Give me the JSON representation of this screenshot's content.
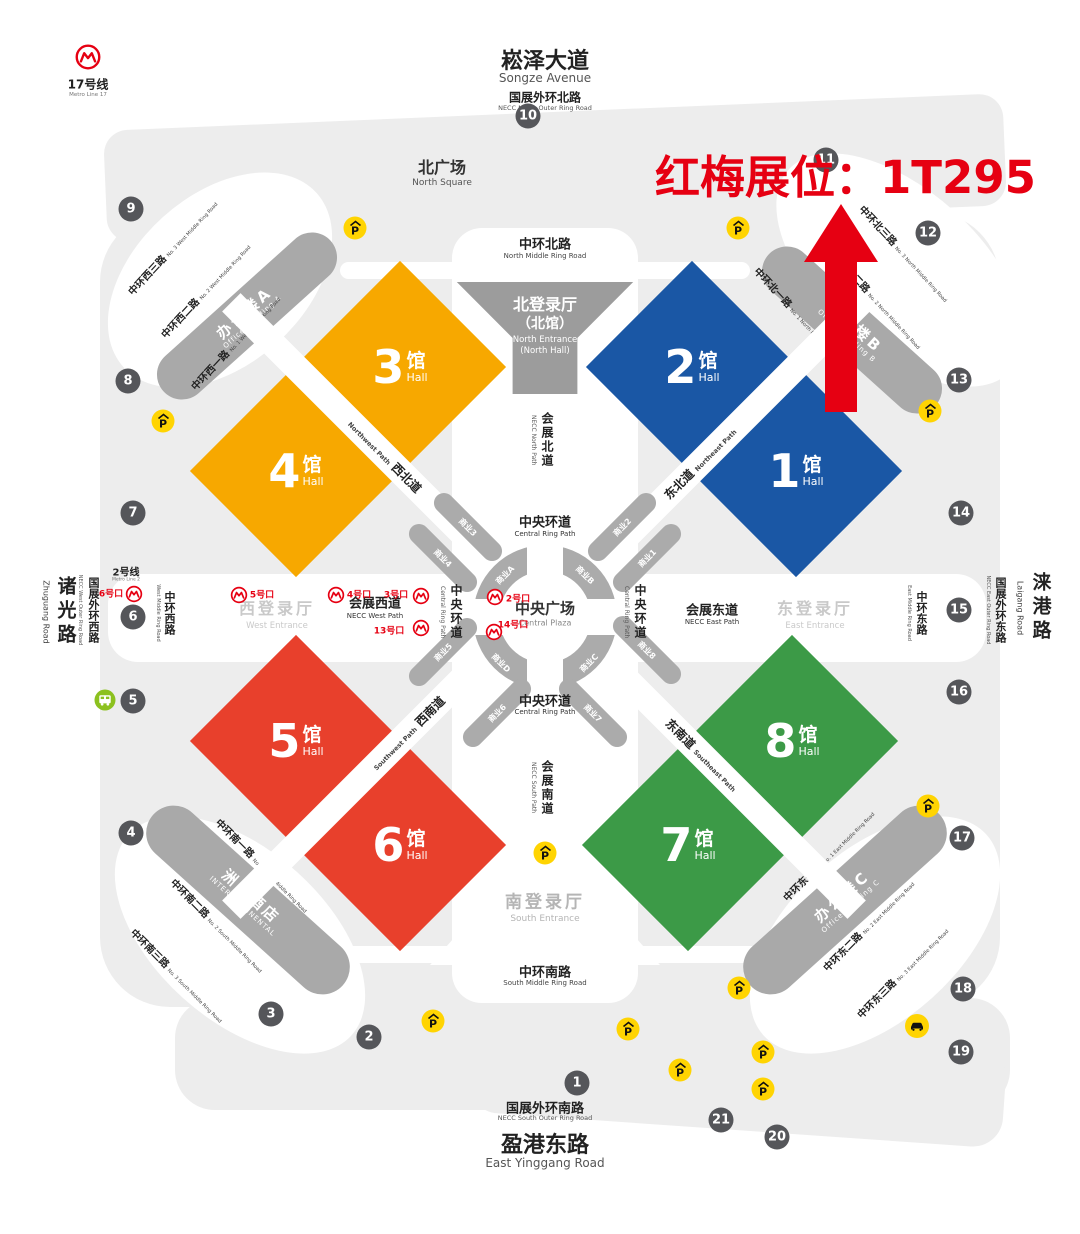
{
  "annotation": {
    "text": "红梅展位：1T295",
    "color": "#e60012"
  },
  "header": {
    "avenue_cn": "崧泽大道",
    "avenue_en": "Songze Avenue",
    "ring_cn": "国展外环北路",
    "ring_en": "NECC North Outer Ring Road",
    "square_cn": "北广场",
    "square_en": "North Square"
  },
  "footer": {
    "ring_cn": "国展外环南路",
    "ring_en": "NECC South Outer Ring Road",
    "road_cn": "盈港东路",
    "road_en": "East Yinggang Road"
  },
  "h_roads": {
    "north_cn": "中环北路",
    "north_en": "North Middle Ring Road",
    "south_cn": "中环南路",
    "south_en": "South Middle Ring Road"
  },
  "left_edge": {
    "zhuguang_cn": "诸光路",
    "zhuguang_en": "Zhuguang Road",
    "outer_cn": "国展外环西路",
    "outer_en": "NECC West Outer Ring Road",
    "middle_cn": "中环西路",
    "middle_en": "West Middle Ring Road"
  },
  "right_edge": {
    "laigang_cn": "涞港路",
    "laigang_en": "Laigang Road",
    "outer_cn": "国展外环东路",
    "outer_en": "NECC East Outer Ring Road",
    "middle_cn": "中环东路",
    "middle_en": "East Middle Ring Road"
  },
  "metro": {
    "line17_cn": "17号线",
    "line17_en": "Metro Line 17",
    "line2_cn": "2号线",
    "line2_en": "Metro Line 2"
  },
  "entrances": {
    "north_cn": "北登录厅",
    "north_cn2": "（北馆）",
    "north_en": "North Entrance",
    "north_en2": "(North Hall)",
    "west_cn": "西登录厅",
    "west_en": "West Entrance",
    "east_cn": "东登录厅",
    "east_en": "East Entrance",
    "south_cn": "南登录厅",
    "south_en": "South Entrance"
  },
  "corridors": {
    "north_cn": "会展北道",
    "north_en": "NECC North Path",
    "south_cn": "会展南道",
    "south_en": "NECC South Path",
    "west_cn": "会展西道",
    "west_en": "NECC West Path",
    "east_cn": "会展东道",
    "east_en": "NECC East Path"
  },
  "plaza": {
    "cn": "中央广场",
    "en": "Central Plaza",
    "ring_cn": "中央环道",
    "ring_en": "Central Ring Path"
  },
  "halls": [
    {
      "name": "hall-3",
      "num": "3",
      "cn": "馆",
      "en": "Hall",
      "color": "#f7a800",
      "cx": 400,
      "cy": 367
    },
    {
      "name": "hall-4",
      "num": "4",
      "cn": "馆",
      "en": "Hall",
      "color": "#f7a800",
      "cx": 296,
      "cy": 471
    },
    {
      "name": "hall-2",
      "num": "2",
      "cn": "馆",
      "en": "Hall",
      "color": "#1a57a5",
      "cx": 692,
      "cy": 367
    },
    {
      "name": "hall-1",
      "num": "1",
      "cn": "馆",
      "en": "Hall",
      "color": "#1a57a5",
      "cx": 796,
      "cy": 471
    },
    {
      "name": "hall-5",
      "num": "5",
      "cn": "馆",
      "en": "Hall",
      "color": "#e8402c",
      "cx": 296,
      "cy": 741
    },
    {
      "name": "hall-6",
      "num": "6",
      "cn": "馆",
      "en": "Hall",
      "color": "#e8402c",
      "cx": 400,
      "cy": 845
    },
    {
      "name": "hall-8",
      "num": "8",
      "cn": "馆",
      "en": "Hall",
      "color": "#3c9a47",
      "cx": 792,
      "cy": 741
    },
    {
      "name": "hall-7",
      "num": "7",
      "cn": "馆",
      "en": "Hall",
      "color": "#3c9a47",
      "cx": 688,
      "cy": 845
    }
  ],
  "paths": [
    {
      "name": "northwest-path",
      "cn": "西北道",
      "en": "Northwest Path",
      "en_first": true,
      "cx": 348,
      "cy": 419,
      "rot": 45,
      "lx": 385,
      "ly": 456
    },
    {
      "name": "northeast-path",
      "cn": "东北道",
      "en": "Northeast Path",
      "en_first": false,
      "cx": 744,
      "cy": 419,
      "rot": -45,
      "lx": 700,
      "ly": 463
    },
    {
      "name": "southwest-path",
      "cn": "西南道",
      "en": "Southwest Path",
      "en_first": true,
      "cx": 348,
      "cy": 793,
      "rot": -45,
      "lx": 408,
      "ly": 733
    },
    {
      "name": "southeast-path",
      "cn": "东南道",
      "en": "Southeast Path",
      "en_first": false,
      "cx": 740,
      "cy": 793,
      "rot": 45,
      "lx": 702,
      "ly": 755
    }
  ],
  "buildings": [
    {
      "name": "office-building-a",
      "cn": "办公楼A",
      "en": "Office Building A",
      "cx": 247,
      "cy": 316,
      "w": 225,
      "h": 50,
      "rot": -42
    },
    {
      "name": "office-building-b",
      "cn": "办公楼B",
      "en": "Office Building B",
      "cx": 852,
      "cy": 330,
      "w": 225,
      "h": 50,
      "rot": 42
    },
    {
      "name": "intercontinental-hotel",
      "cn": "洲际酒店",
      "en": "INTERCONTINENTAL",
      "cx": 248,
      "cy": 900,
      "w": 255,
      "h": 55,
      "rot": 42
    },
    {
      "name": "office-building-c",
      "cn": "办公楼C",
      "en": "Office Building C",
      "cx": 845,
      "cy": 900,
      "w": 255,
      "h": 55,
      "rot": -42
    }
  ],
  "diag_roads": [
    {
      "cn": "中环西三路",
      "en": "No. 3 West Middle Ring Road",
      "x": 172,
      "y": 247,
      "rot": -47
    },
    {
      "cn": "中环西二路",
      "en": "No. 2 West Middle Ring Road",
      "x": 205,
      "y": 290,
      "rot": -47
    },
    {
      "cn": "中环西一路",
      "en": "No. 1 West Middle Ring Road",
      "x": 235,
      "y": 342,
      "rot": -47
    },
    {
      "cn": "中环北一路",
      "en": "No. 1 North Middle Ring Road",
      "x": 800,
      "y": 315,
      "rot": 47
    },
    {
      "cn": "中环北二路",
      "en": "No. 2 North Middle Ring Road",
      "x": 878,
      "y": 300,
      "rot": 47
    },
    {
      "cn": "中环北三路",
      "en": "No. 3 North Middle Ring Road",
      "x": 905,
      "y": 253,
      "rot": 47
    },
    {
      "cn": "中环南一路",
      "en": "No. 1 South Middle Ring Road",
      "x": 263,
      "y": 865,
      "rot": 45
    },
    {
      "cn": "中环南二路",
      "en": "No. 2 South Middle Ring Road",
      "x": 218,
      "y": 925,
      "rot": 45
    },
    {
      "cn": "中环南三路",
      "en": "No. 3 South Middle Ring Road",
      "x": 178,
      "y": 975,
      "rot": 45
    },
    {
      "cn": "中环东一路",
      "en": "No. 1 East Middle Ring Road",
      "x": 828,
      "y": 855,
      "rot": -45
    },
    {
      "cn": "中环东二路",
      "en": "No. 2 East Middle Ring Road",
      "x": 868,
      "y": 925,
      "rot": -45
    },
    {
      "cn": "中环东三路",
      "en": "No. 3 East Middle Ring Road",
      "x": 902,
      "y": 972,
      "rot": -45
    }
  ],
  "ring_quarters": [
    {
      "t": "商业A",
      "x": 503,
      "y": 573,
      "rot": -45
    },
    {
      "t": "商业B",
      "x": 587,
      "y": 573,
      "rot": 45
    },
    {
      "t": "商业C",
      "x": 587,
      "y": 661,
      "rot": -45
    },
    {
      "t": "商业D",
      "x": 503,
      "y": 661,
      "rot": 45
    }
  ],
  "stubs": [
    {
      "t": "商业3",
      "x": 468,
      "y": 527,
      "rot": 45
    },
    {
      "t": "商业2",
      "x": 622,
      "y": 527,
      "rot": -45
    },
    {
      "t": "商业4",
      "x": 443,
      "y": 558,
      "rot": 45
    },
    {
      "t": "商业1",
      "x": 647,
      "y": 558,
      "rot": -45
    },
    {
      "t": "商业5",
      "x": 443,
      "y": 652,
      "rot": -45
    },
    {
      "t": "商业8",
      "x": 647,
      "y": 650,
      "rot": 45
    },
    {
      "t": "商业6",
      "x": 497,
      "y": 713,
      "rot": -45
    },
    {
      "t": "商业7",
      "x": 593,
      "y": 713,
      "rot": 45
    }
  ],
  "markers": [
    {
      "n": "1",
      "x": 577,
      "y": 1083
    },
    {
      "n": "2",
      "x": 369,
      "y": 1037
    },
    {
      "n": "3",
      "x": 271,
      "y": 1014
    },
    {
      "n": "4",
      "x": 131,
      "y": 833
    },
    {
      "n": "5",
      "x": 133,
      "y": 701
    },
    {
      "n": "6",
      "x": 133,
      "y": 617
    },
    {
      "n": "7",
      "x": 133,
      "y": 513
    },
    {
      "n": "8",
      "x": 128,
      "y": 381
    },
    {
      "n": "9",
      "x": 131,
      "y": 209
    },
    {
      "n": "10",
      "x": 528,
      "y": 116
    },
    {
      "n": "11",
      "x": 826,
      "y": 160
    },
    {
      "n": "12",
      "x": 928,
      "y": 233
    },
    {
      "n": "13",
      "x": 959,
      "y": 380
    },
    {
      "n": "14",
      "x": 961,
      "y": 513
    },
    {
      "n": "15",
      "x": 959,
      "y": 610
    },
    {
      "n": "16",
      "x": 959,
      "y": 692
    },
    {
      "n": "17",
      "x": 962,
      "y": 838
    },
    {
      "n": "18",
      "x": 963,
      "y": 989
    },
    {
      "n": "19",
      "x": 961,
      "y": 1052
    },
    {
      "n": "20",
      "x": 777,
      "y": 1137
    },
    {
      "n": "21",
      "x": 721,
      "y": 1120
    }
  ],
  "parkings": [
    {
      "x": 355,
      "y": 228
    },
    {
      "x": 738,
      "y": 228
    },
    {
      "x": 163,
      "y": 421
    },
    {
      "x": 930,
      "y": 411
    },
    {
      "x": 545,
      "y": 853
    },
    {
      "x": 928,
      "y": 806
    },
    {
      "x": 739,
      "y": 988
    },
    {
      "x": 433,
      "y": 1021
    },
    {
      "x": 628,
      "y": 1029
    },
    {
      "x": 763,
      "y": 1052
    },
    {
      "x": 680,
      "y": 1070
    },
    {
      "x": 763,
      "y": 1089
    }
  ],
  "metro_exits": [
    {
      "t": "6号口",
      "tx": 111,
      "ty": 593,
      "ix": 134,
      "iy": 594
    },
    {
      "t": "5号口",
      "tx": 262,
      "ty": 594,
      "ix": 239,
      "iy": 595
    },
    {
      "t": "4号口",
      "tx": 359,
      "ty": 594,
      "ix": 336,
      "iy": 595
    },
    {
      "t": "3号口",
      "tx": 396,
      "ty": 594,
      "ix": 421,
      "iy": 596
    },
    {
      "t": "13号口",
      "tx": 389,
      "ty": 630,
      "ix": 421,
      "iy": 628
    },
    {
      "t": "2号口",
      "tx": 518,
      "ty": 598,
      "ix": 495,
      "iy": 597
    },
    {
      "t": "14号口",
      "tx": 513,
      "ty": 624,
      "ix": 494,
      "iy": 632
    }
  ],
  "vehicles": {
    "car_x": 917,
    "car_y": 1026,
    "bus_x": 105,
    "bus_y": 700
  }
}
